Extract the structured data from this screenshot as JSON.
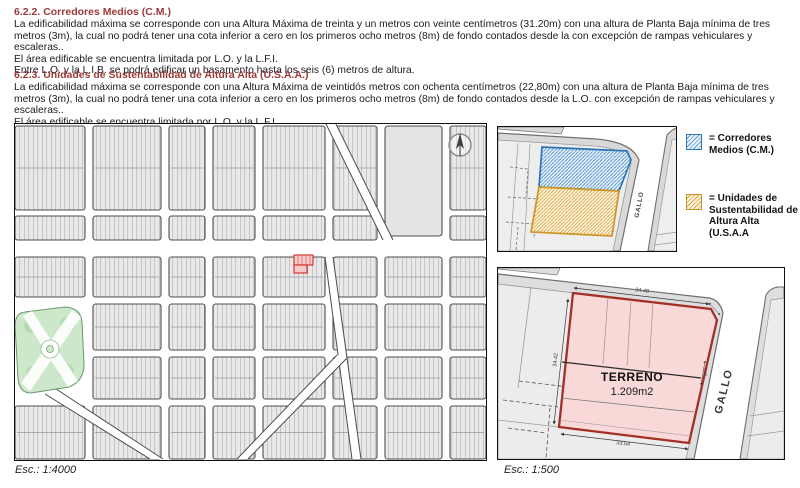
{
  "document": {
    "sections": [
      {
        "heading": "6.2.2. Corredores Medios (C.M.)",
        "paragraphs": [
          "La edificabilidad máxima se corresponde con una Altura Máxima de treinta y un metros con veinte centímetros (31.20m) con una altura de Planta Baja mínima de tres metros (3m), la cual no podrá tener una cota inferior a cero en los primeros ocho metros (8m) de fondo contados desde la con excepción de rampas vehiculares y escaleras..",
          "El área edificable se encuentra limitada por L.O. y la L.F.I.",
          "Entre L.O. y la L.I.B. se podrá edificar un basamento hasta los seis (6) metros de altura."
        ]
      },
      {
        "heading": "6.2.3. Unidades de Sustentabilidad de Altura Alta (U.S.A.A.)",
        "paragraphs": [
          "La edificabilidad máxima se corresponde con una Altura Máxima de veintidós metros con ochenta centímetros (22,80m) con una altura de Planta Baja mínima de tres metros (3m), la cual no podrá tener una cota inferior a cero en los primeros ocho metros (8m) de fondo contados desde la L.O. con excepción de rampas vehiculares y escaleras..",
          "El área edificable se encuentra limitada por L.O. y la L.F.I."
        ]
      }
    ]
  },
  "main_map": {
    "scale_label": "Esc.: 1:4000"
  },
  "block_figure": {
    "street_label": "GALLO"
  },
  "legend": {
    "items": [
      {
        "label": "= Corredores\nMedios (C.M.)",
        "swatch_color": "#2e75b5"
      },
      {
        "label": "= Unidades de\nSustentabilidad de\nAltura Alta (U.S.A.A",
        "swatch_color": "#c8922a"
      }
    ]
  },
  "parcel_figure": {
    "scale_label": "Esc.: 1:500",
    "street_label": "GALLO",
    "parcel_name": "TERRENO",
    "parcel_area": "1.209m2",
    "dimensions": {
      "top": "34.48",
      "left": "34.42",
      "bottom": "33.54",
      "right": "11.11"
    }
  },
  "colors": {
    "heading_red": "#9b3a38",
    "corredores_blue": "#2e75b5",
    "usaa_orange": "#c8922a",
    "parcel_outline_red": "#a33028",
    "parcel_fill_pink": "#f9d8d8",
    "map_highlight_red": "#d03a34",
    "plaza_green": "#cde7cb"
  }
}
